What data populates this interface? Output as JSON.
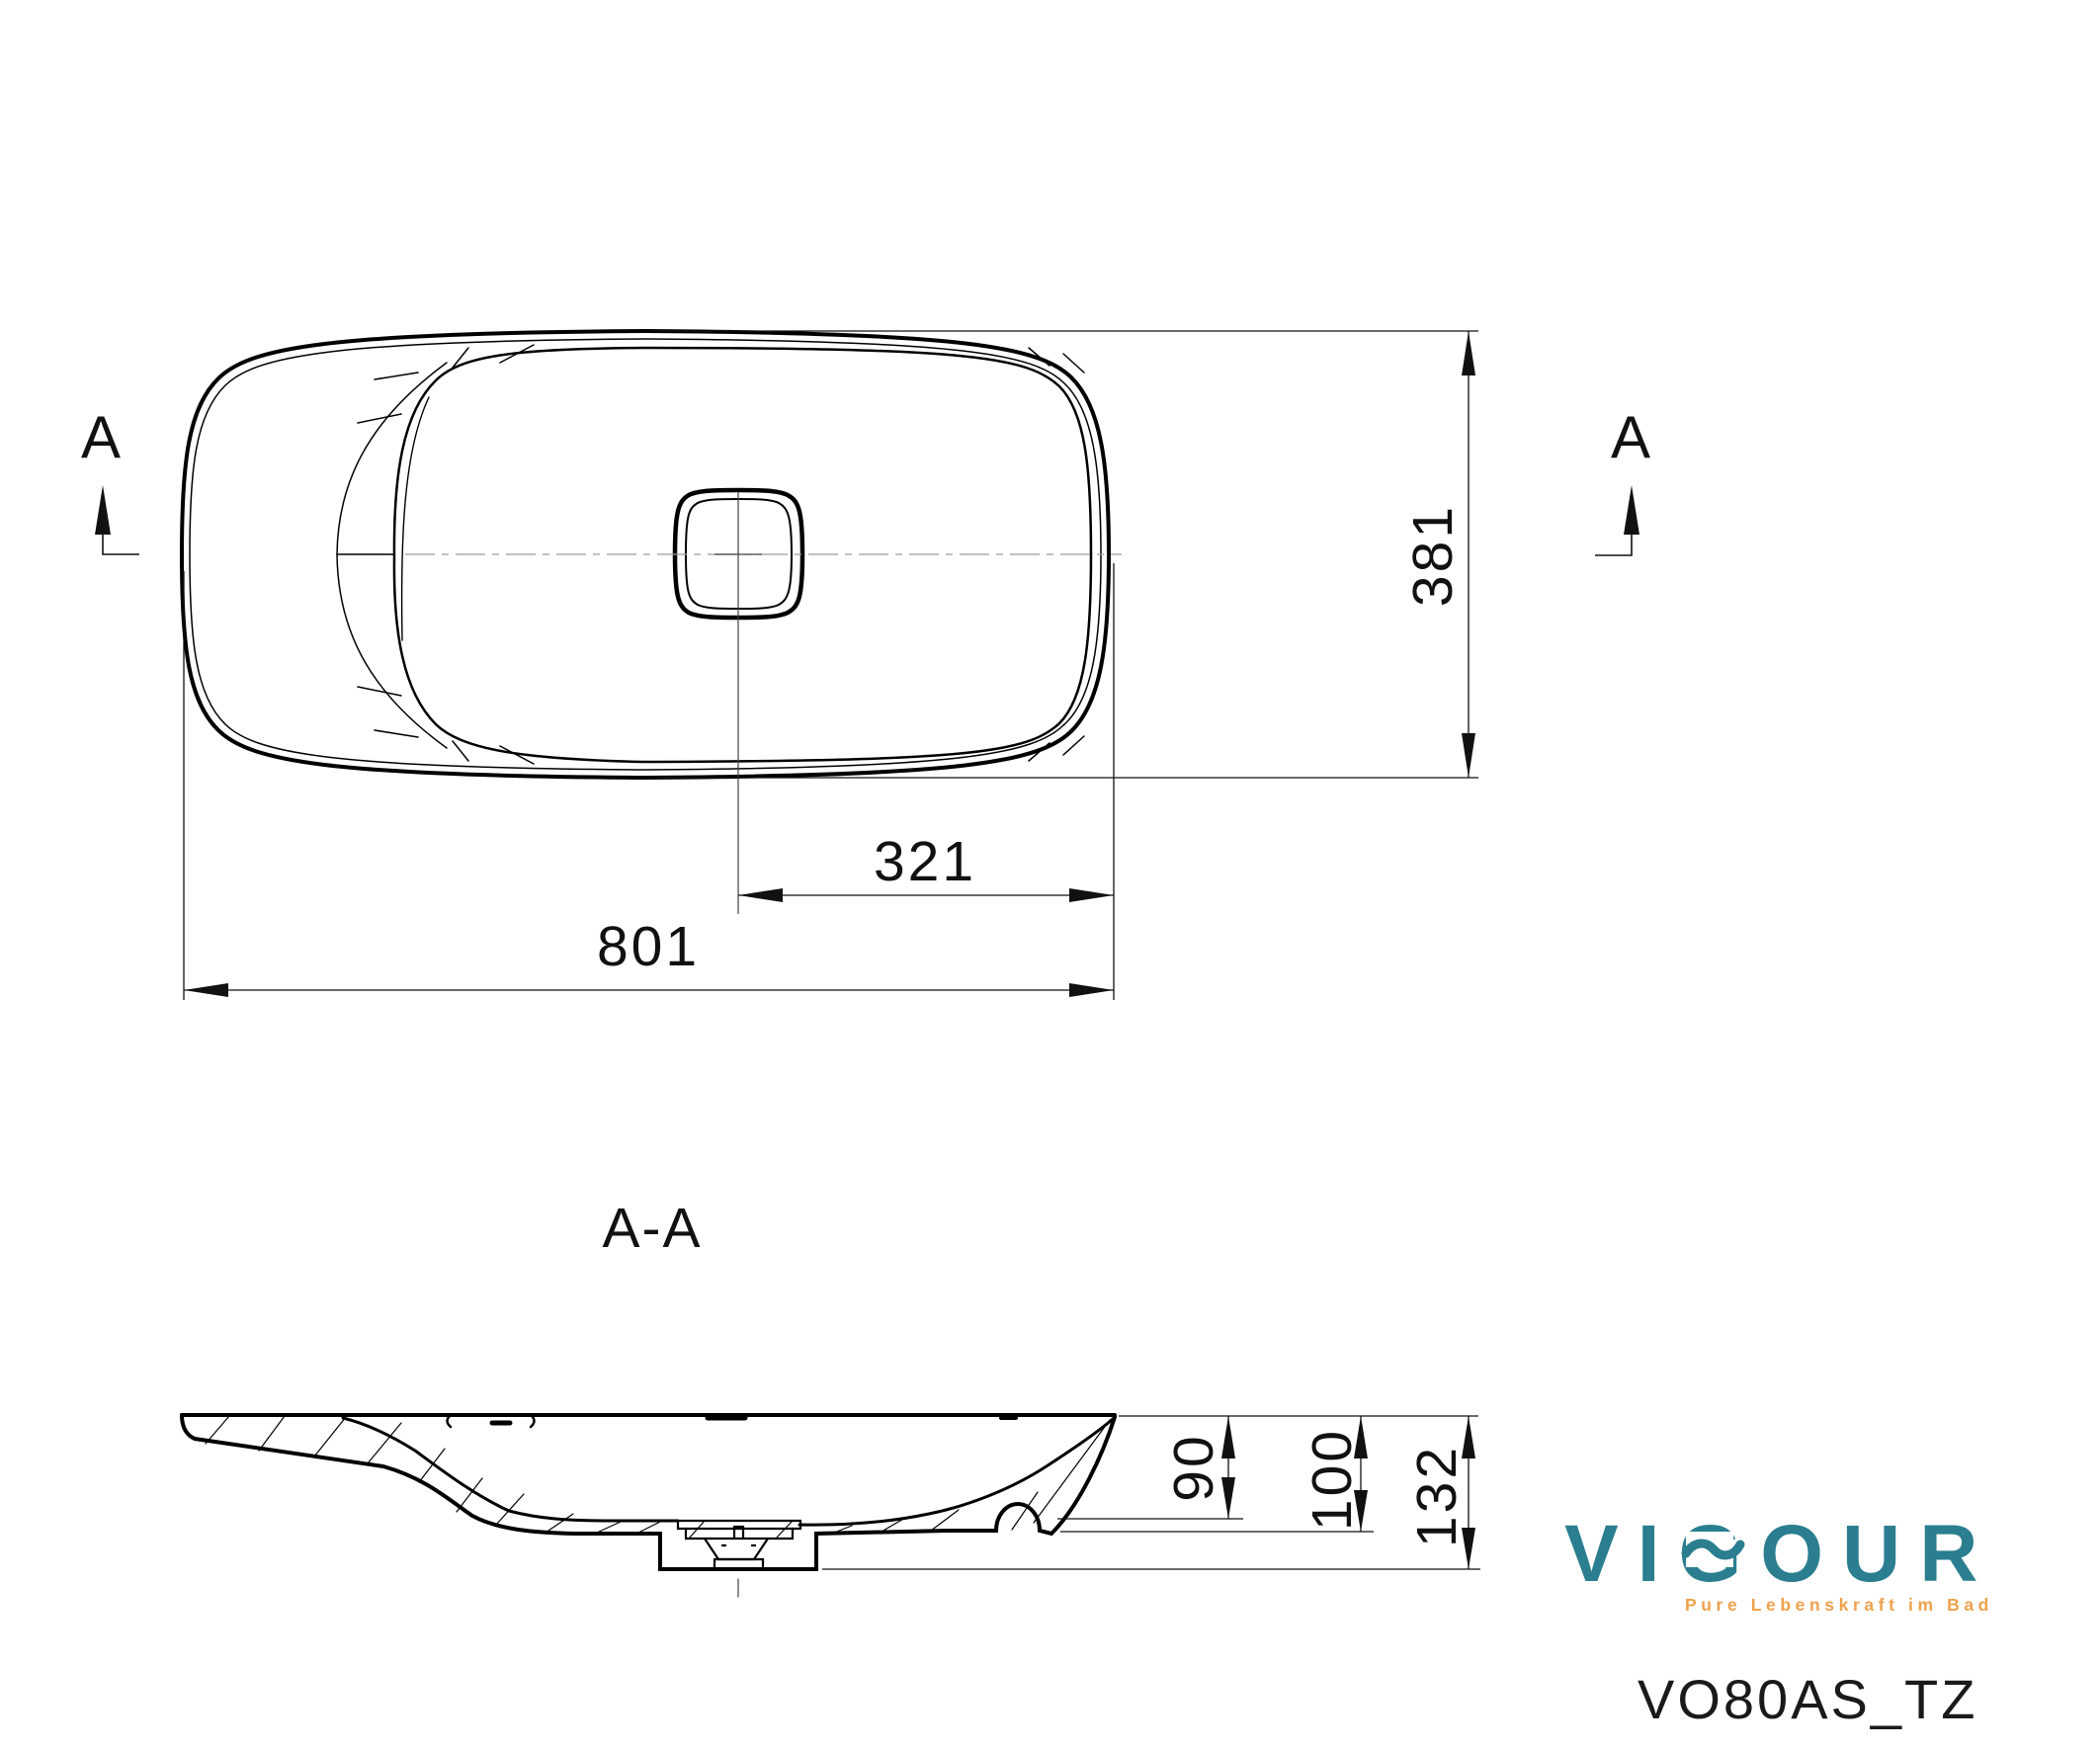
{
  "drawing": {
    "type": "technical-drawing",
    "product": "washbasin",
    "model_code": "VO80AS_TZ"
  },
  "views": {
    "plan": {
      "section_marker_left": "A",
      "section_marker_right": "A"
    },
    "section": {
      "label": "A-A"
    }
  },
  "dimensions": {
    "width_total": "801",
    "drain_to_right_edge": "321",
    "depth_total": "381",
    "bowl_depth": "90",
    "height_to_bottom": "100",
    "height_total": "132"
  },
  "logo": {
    "brand": "VIGOUR",
    "tagline": "Pure Lebenskraft im Bad",
    "brand_color": "#2A7E8F",
    "tagline_color": "#EFA14D"
  },
  "colors": {
    "line": "#000000",
    "centerline": "#9c9c9c",
    "text": "#111111"
  }
}
